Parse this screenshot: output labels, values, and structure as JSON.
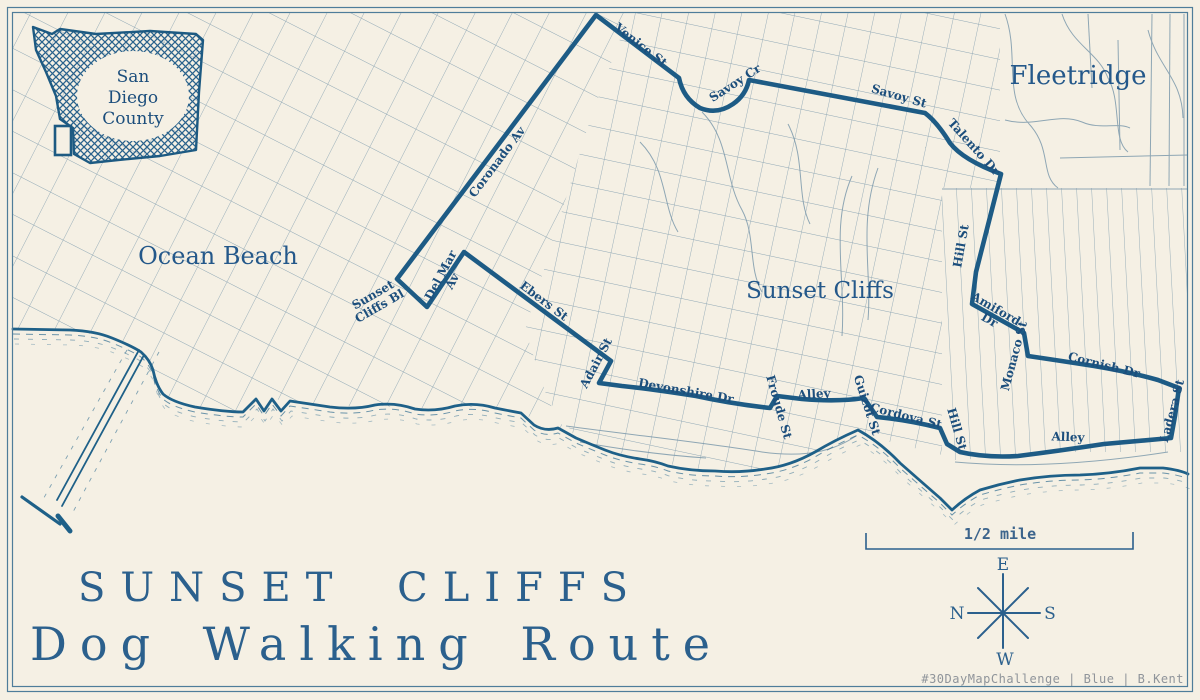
{
  "map": {
    "title_line1": "SUNSET CLIFFS",
    "title_line2": "Dog Walking Route",
    "attribution": "#30DayMapChallenge | Blue | B.Kent",
    "scale_label": "1/2 mile",
    "inset_line1": "San",
    "inset_line2": "Diego",
    "inset_line3": "County",
    "compass": {
      "top": "E",
      "right": "S",
      "bottom": "W",
      "left": "N"
    },
    "area_labels": [
      {
        "text": "Ocean Beach",
        "x": 218,
        "y": 260,
        "size": 24
      },
      {
        "text": "Sunset Cliffs",
        "x": 820,
        "y": 294,
        "size": 23
      },
      {
        "text": "Fleetridge",
        "x": 1078,
        "y": 80,
        "size": 26
      }
    ],
    "street_labels": [
      {
        "text": "Coronado Av",
        "x": 497,
        "y": 162,
        "r": -53
      },
      {
        "text": "Venice St",
        "x": 641,
        "y": 45,
        "r": 38
      },
      {
        "text": "Savoy Cr",
        "x": 735,
        "y": 83,
        "r": -33
      },
      {
        "text": "Savoy St",
        "x": 899,
        "y": 96,
        "r": 16
      },
      {
        "text": "Talento Dr",
        "x": 974,
        "y": 147,
        "r": 48
      },
      {
        "text": "Hill St",
        "x": 961,
        "y": 246,
        "r": -80
      },
      {
        "text": "Amiford\nDr",
        "x": 993,
        "y": 314,
        "r": 30
      },
      {
        "text": "Monaco St",
        "x": 1014,
        "y": 356,
        "r": -75
      },
      {
        "text": "Cornish Dr",
        "x": 1104,
        "y": 365,
        "r": 14
      },
      {
        "text": "Ladera St",
        "x": 1172,
        "y": 411,
        "r": -75
      },
      {
        "text": "Alley",
        "x": 1068,
        "y": 437,
        "r": 2
      },
      {
        "text": "Hill St",
        "x": 957,
        "y": 429,
        "r": 74
      },
      {
        "text": "Cordova St",
        "x": 906,
        "y": 416,
        "r": 14
      },
      {
        "text": "Guizot St",
        "x": 867,
        "y": 405,
        "r": 72
      },
      {
        "text": "Alley",
        "x": 814,
        "y": 394,
        "r": -3
      },
      {
        "text": "Froude St",
        "x": 779,
        "y": 407,
        "r": 74
      },
      {
        "text": "Devonshire Dr",
        "x": 686,
        "y": 391,
        "r": 10
      },
      {
        "text": "Adair St",
        "x": 596,
        "y": 363,
        "r": -62
      },
      {
        "text": "Ebers St",
        "x": 544,
        "y": 301,
        "r": 37
      },
      {
        "text": "Del Mar\nAv",
        "x": 446,
        "y": 278,
        "r": -62
      },
      {
        "text": "Sunset\nCliffs Bl",
        "x": 376,
        "y": 300,
        "r": -30
      }
    ],
    "colors": {
      "paper": "#f5f0e4",
      "route": "#1d5b85",
      "coast": "#1e6088",
      "grid": "#7d9aac",
      "street_label": "#1c4e7c",
      "title": "#2b608d",
      "attribution": "#8f949a"
    },
    "route_path": "M596,15 L679,78 Q683,98 700,108 Q717,115 733,104 Q746,95 749,80 L925,113 Q937,122 950,143 Q963,160 1001,174 L988,225 L976,272 L972,304 L1024,333 L1028,356 Q1062,361 1094,366 Q1130,372 1158,380 L1179,388 L1175,416 L1171,438 Q1138,441 1104,444 Q1058,451 1018,456 Q986,458 960,452 L947,444 L940,428 Q908,420 877,417 L864,398 Q838,402 802,399 L777,396 L770,408 Q733,404 696,396 Q652,389 622,386 L599,383 L611,361 L464,252 L427,307 L397,279 Z",
    "coast_path": "M13,329 L70,330 Q95,331 112,338 Q132,346 141,352 Q150,360 153,370 Q156,385 163,394 Q172,402 195,407 Q225,412 243,412 L256,399 L264,411 L272,399 L281,411 L290,401 Q310,404 330,407 Q355,410 375,405 Q395,402 415,409 Q435,412 455,406 Q475,402 495,408 Q510,411 521,413 L534,425 Q545,432 558,428 L576,438 Q590,444 605,450 Q620,456 640,459 Q655,461 668,466 Q690,471 715,471 Q740,473 765,469 Q790,466 815,452 Q835,440 858,430 Q880,442 900,463 Q925,485 940,498 L952,510 Q965,498 980,490 Q1000,484 1020,480 Q1050,475 1080,475 Q1110,474 1140,468 L1163,468 Q1180,470 1188,474"
  }
}
